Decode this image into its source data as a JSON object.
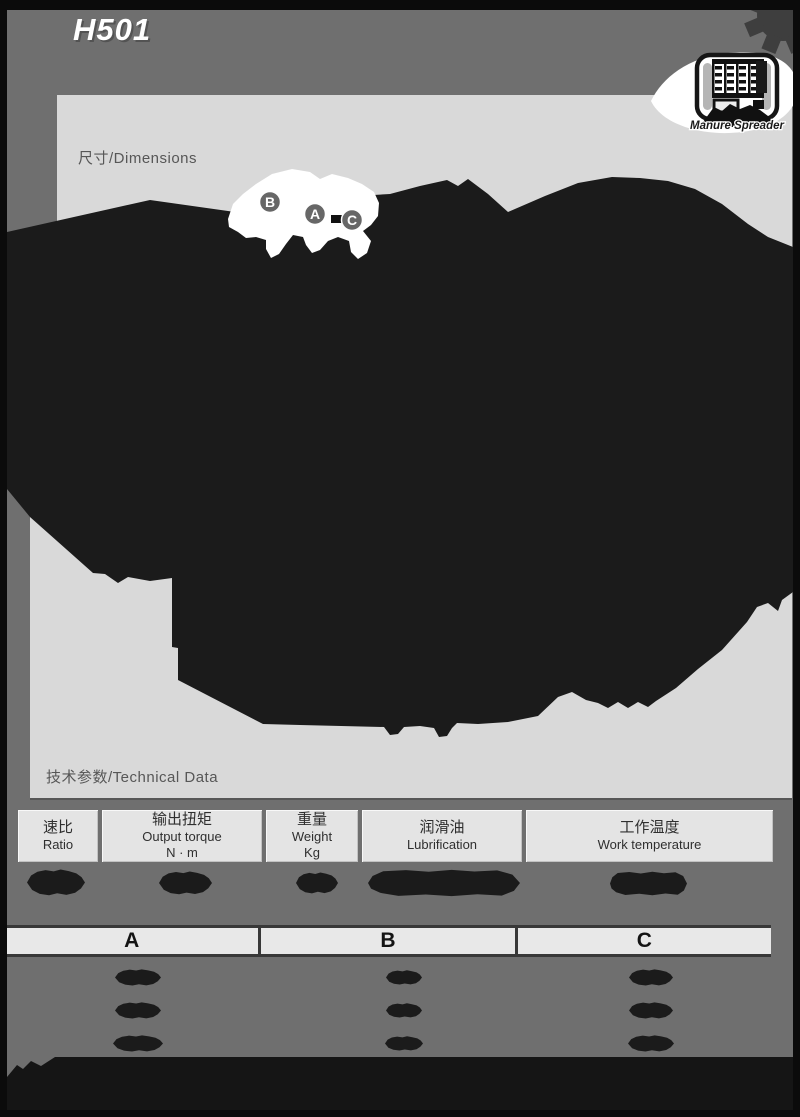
{
  "header": {
    "model": "H501",
    "badge": {
      "label": "Manure Spreader"
    }
  },
  "panel": {
    "dimensions_label": "尺寸/Dimensions",
    "technical_label": "技术参数/Technical Data"
  },
  "drawing": {
    "description": "black silhouette dimensional drawing (illegible)",
    "callouts": [
      "B",
      "A",
      "C"
    ]
  },
  "tables": {
    "technical": {
      "columns": [
        {
          "zh": "速比",
          "en": "Ratio",
          "unit": ""
        },
        {
          "zh": "输出扭矩",
          "en": "Output torque",
          "unit": "N · m"
        },
        {
          "zh": "重量",
          "en": "Weight",
          "unit": "Kg"
        },
        {
          "zh": "润滑油",
          "en": "Lubrification",
          "unit": ""
        },
        {
          "zh": "工作温度",
          "en": "Work temperature",
          "unit": ""
        }
      ],
      "values_redacted": true
    },
    "dimensions": {
      "columns": [
        "A",
        "B",
        "C"
      ],
      "redacted_rows": 3
    }
  },
  "colors": {
    "frame": "#0b0b0b",
    "background": "#6f6f6f",
    "panel": "#d9d9d9",
    "ink": "#1b1b1b",
    "cell": "#e4e4e4",
    "title": "#ffffff"
  }
}
